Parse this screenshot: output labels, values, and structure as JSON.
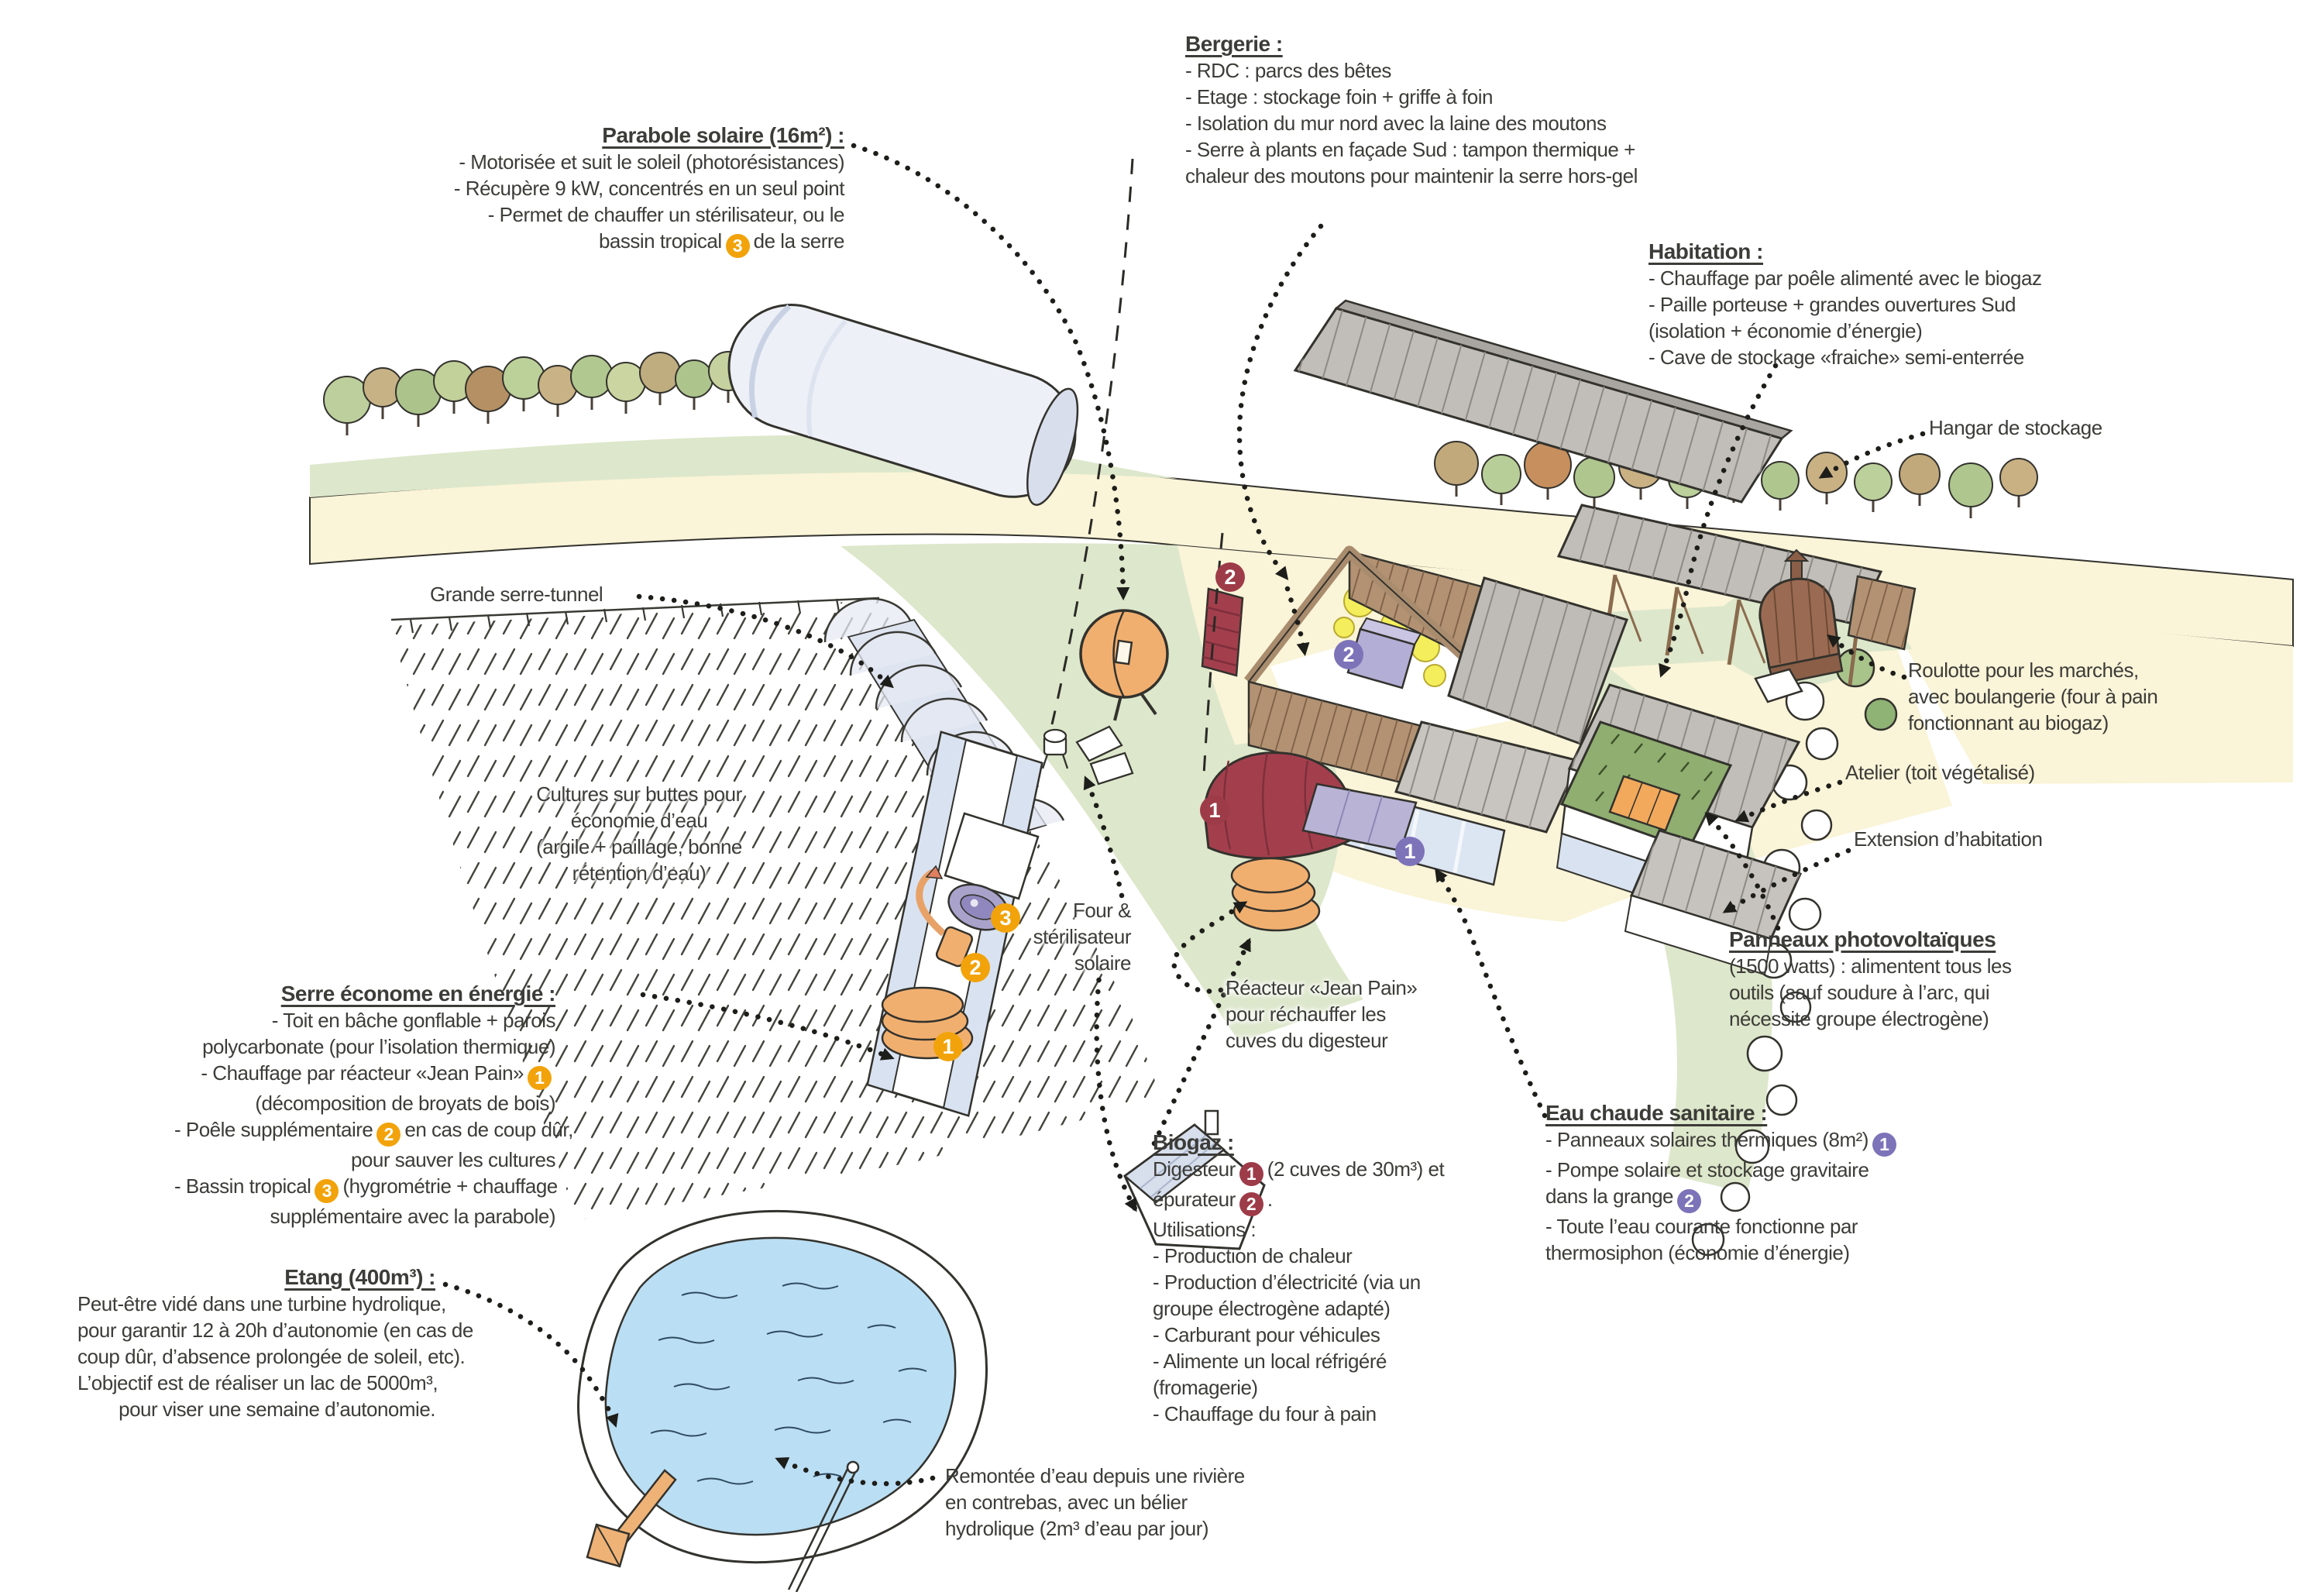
{
  "annotations": {
    "bergerie": {
      "title": "Bergerie :",
      "l1": "- RDC : parcs des bêtes",
      "l2": "- Etage : stockage foin + griffe à foin",
      "l3": "- Isolation du mur nord avec la laine des moutons",
      "l4": "- Serre à plants en façade Sud : tampon thermique +",
      "l5": "chaleur des moutons pour maintenir la serre hors-gel"
    },
    "parabole": {
      "title": "Parabole solaire (16m²) :",
      "l1": "- Motorisée et suit le soleil (photorésistances)",
      "l2": "- Récupère 9 kW, concentrés en un seul point",
      "l3": "- Permet de chauffer un stérilisateur, ou le",
      "l4_pre": "bassin tropical",
      "l4_badge": "3",
      "l4_post": "de la serre"
    },
    "habitation": {
      "title": "Habitation :",
      "l1": "- Chauffage par poêle alimenté avec le biogaz",
      "l2": "- Paille porteuse + grandes ouvertures Sud",
      "l3": "(isolation + économie d’énergie)",
      "l4": "- Cave de stockage «fraiche» semi-enterrée"
    },
    "hangar": {
      "label": "Hangar de stockage"
    },
    "grande_serre": {
      "label": "Grande serre-tunnel"
    },
    "cultures": {
      "l1": "Cultures sur buttes pour",
      "l2": "économie d’eau",
      "l3": "(argile + paillage, bonne",
      "l4": "rétention d’eau)"
    },
    "four_solaire": {
      "l1": "Four &",
      "l2": "stérilisateur",
      "l3": "solaire"
    },
    "reacteur": {
      "l1": "Réacteur «Jean Pain»",
      "l2": "pour réchauffer les",
      "l3": "cuves du digesteur"
    },
    "roulotte": {
      "l1": "Roulotte pour les marchés,",
      "l2": "avec boulangerie (four à pain",
      "l3": "fonctionnant au biogaz)"
    },
    "atelier": {
      "label": "Atelier (toit végétalisé)"
    },
    "extension": {
      "label": "Extension d’habitation"
    },
    "pv": {
      "title": "Panneaux photovoltaïques",
      "l1": "(1500 watts) : alimentent tous les",
      "l2": "outils (sauf soudure à l’arc, qui",
      "l3": "nécessite groupe électrogène)"
    },
    "serre_energie": {
      "title": "Serre économe en énergie :",
      "l1": "- Toit en bâche gonflable + parois",
      "l2": "polycarbonate (pour l’isolation thermique)",
      "l3_pre": "- Chauffage par réacteur «Jean Pain»",
      "l3_badge": "1",
      "l4": "(décomposition de broyats de bois)",
      "l5_pre": "- Poêle supplémentaire",
      "l5_badge": "2",
      "l5_post": "en cas de coup dûr,",
      "l6": "pour sauver les cultures",
      "l7_pre": "- Bassin tropical",
      "l7_badge": "3",
      "l7_post": "(hygrométrie + chauffage",
      "l8": "supplémentaire avec la parabole)"
    },
    "etang": {
      "title": "Etang (400m³) :",
      "l1": "Peut-être vidé dans une turbine hydrolique,",
      "l2": "pour garantir 12 à 20h d’autonomie (en cas de",
      "l3": "coup dûr, d’absence prolongée de soleil, etc).",
      "l4": "L’objectif est de réaliser un lac de 5000m³,",
      "l5": "pour viser une semaine d’autonomie."
    },
    "biogaz": {
      "title": "Biogaz :",
      "l1_pre": "Digesteur",
      "l1_badge": "1",
      "l1_post": "(2 cuves de 30m³) et",
      "l2_pre": "épurateur",
      "l2_badge": "2",
      "l2_post": ".",
      "l3": "Utilisations :",
      "l4": "- Production de chaleur",
      "l5": "- Production d’électricité (via un",
      "l6": "groupe électrogène adapté)",
      "l7": "- Carburant pour véhicules",
      "l8": "- Alimente un local réfrigéré",
      "l9": "(fromagerie)",
      "l10": "- Chauffage du four à pain"
    },
    "eau_chaude": {
      "title": "Eau chaude sanitaire :",
      "l1_pre": "- Panneaux solaires thermiques (8m²)",
      "l1_badge": "1",
      "l2": "- Pompe solaire et stockage gravitaire",
      "l3_pre": "dans la grange",
      "l3_badge": "2",
      "l4": "- Toute l’eau courante fonctionne par",
      "l5": "thermosiphon (économie d’énergie)"
    },
    "remontee": {
      "l1": "Remontée d’eau depuis une rivière",
      "l2": "en contrebas, avec un bélier",
      "l3": "hydrolique (2m³ d’eau par jour)"
    }
  },
  "illustration": {
    "badges": {
      "serre_bassin": "3",
      "serre_poele": "2",
      "serre_reacteur": "1",
      "digesteur": "1",
      "epurateur": "2",
      "grange_stockage": "1",
      "serre_plants": "2"
    }
  },
  "colors": {
    "badge_orange": "#F2A30B",
    "badge_maroon": "#9E3B48",
    "badge_purple": "#7D73B9",
    "text": "#3C3C38",
    "water": "#BADEF3",
    "road": "#FAF4D8",
    "meadow": "#DDE7CB",
    "hay": "#F3EE58",
    "wood": "#B29273",
    "roof_grey": "#C1BEB9",
    "green_roof": "#8FAE70"
  }
}
